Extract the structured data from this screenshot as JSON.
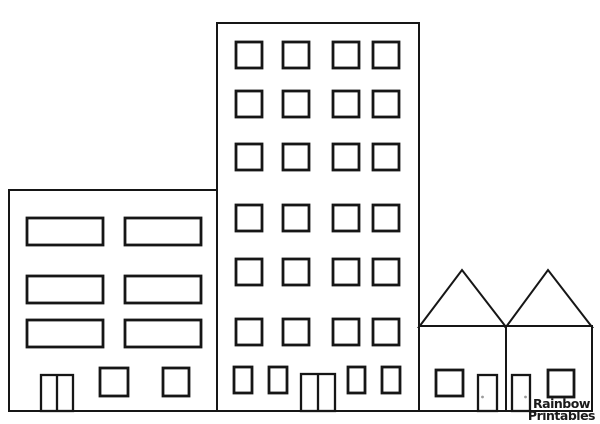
{
  "watermark": {
    "line1": "Rainbow",
    "line2": "Printables",
    "color": "#1a1a1a"
  },
  "scene": {
    "description": "black line-art coloring page of four buildings standing on a common ground line",
    "background": "#ffffff",
    "stroke_color": "#161616",
    "outline_width": 2,
    "window_stroke_width": 2.8,
    "door_stroke_width": 2.3,
    "knob_color": "#9c9c9c",
    "ground_y": 411,
    "buildings": [
      {
        "id": "apartment-building",
        "x": 9,
        "y": 190,
        "w": 208,
        "h": 221,
        "window_grid": {
          "col_x": [
            27,
            125
          ],
          "row_y": [
            218,
            276,
            320
          ],
          "w": 76,
          "h": 27
        },
        "extra_windows": [
          {
            "x": 100,
            "y": 368,
            "w": 28,
            "h": 28
          },
          {
            "x": 163,
            "y": 368,
            "w": 26,
            "h": 28
          }
        ],
        "door": {
          "x": 41,
          "y": 375,
          "w": 32,
          "h": 36,
          "double": true
        }
      },
      {
        "id": "tower-building",
        "x": 217,
        "y": 23,
        "w": 202,
        "h": 388,
        "window_grid": {
          "col_x": [
            236,
            283,
            333,
            373
          ],
          "row_y": [
            42,
            91,
            144,
            205,
            259,
            319
          ],
          "w": 26,
          "h": 26
        },
        "extra_windows": [
          {
            "x": 234,
            "y": 367,
            "w": 18,
            "h": 26
          },
          {
            "x": 269,
            "y": 367,
            "w": 18,
            "h": 26
          },
          {
            "x": 348,
            "y": 367,
            "w": 17,
            "h": 26
          },
          {
            "x": 382,
            "y": 367,
            "w": 18,
            "h": 26
          }
        ],
        "door": {
          "x": 301,
          "y": 374,
          "w": 34,
          "h": 37,
          "double": true
        }
      },
      {
        "id": "house-left",
        "x": 419,
        "y": 326,
        "w": 87,
        "h": 85,
        "roof": {
          "peak_x": 462,
          "peak_y": 270
        },
        "extra_windows": [
          {
            "x": 436,
            "y": 370,
            "w": 27,
            "h": 26
          }
        ],
        "door": {
          "x": 478,
          "y": 375,
          "w": 19,
          "h": 36,
          "knob_x": 482.5,
          "knob_y": 397
        }
      },
      {
        "id": "house-right",
        "x": 506,
        "y": 326,
        "w": 86,
        "h": 85,
        "roof": {
          "peak_x": 548,
          "peak_y": 270
        },
        "extra_windows": [
          {
            "x": 548,
            "y": 370,
            "w": 26,
            "h": 27
          }
        ],
        "door": {
          "x": 512,
          "y": 375,
          "w": 18,
          "h": 36,
          "knob_x": 525.5,
          "knob_y": 397
        }
      }
    ]
  }
}
